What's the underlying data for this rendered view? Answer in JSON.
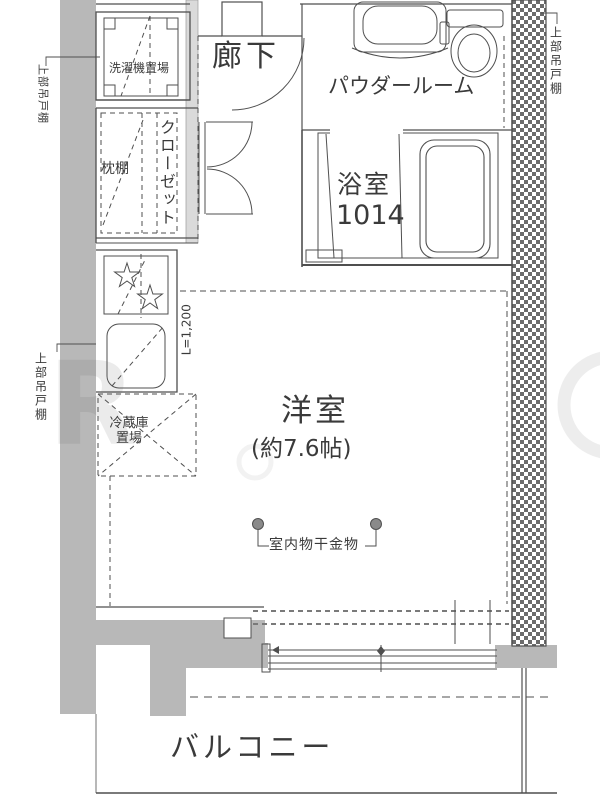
{
  "floorplan": {
    "rooms": {
      "corridor": {
        "label": "廊下"
      },
      "powder_room": {
        "label": "パウダールーム"
      },
      "bathroom": {
        "label": "浴室",
        "size": "1014"
      },
      "closet": {
        "label": "クローゼット",
        "shelf": "枕棚"
      },
      "western_room": {
        "label": "洋室",
        "size": "(約7.6帖)"
      },
      "balcony": {
        "label": "バルコニー"
      }
    },
    "fixtures": {
      "washer_space": "洗濯機置場",
      "fridge_space": "冷蔵庫\n置場",
      "laundry_hardware": "室内物干金物",
      "kitchen_length": "L=1,200",
      "upper_cabinet_top_left": "上部吊戸棚",
      "upper_cabinet_left": "上部吊戸棚",
      "upper_cabinet_right": "上部吊戸棚"
    },
    "watermark": "R",
    "colors": {
      "line": "#4f4f4f",
      "wall_gray": "#b8b8b8",
      "light_wall": "#dadada",
      "text": "#3a3a3a"
    }
  }
}
